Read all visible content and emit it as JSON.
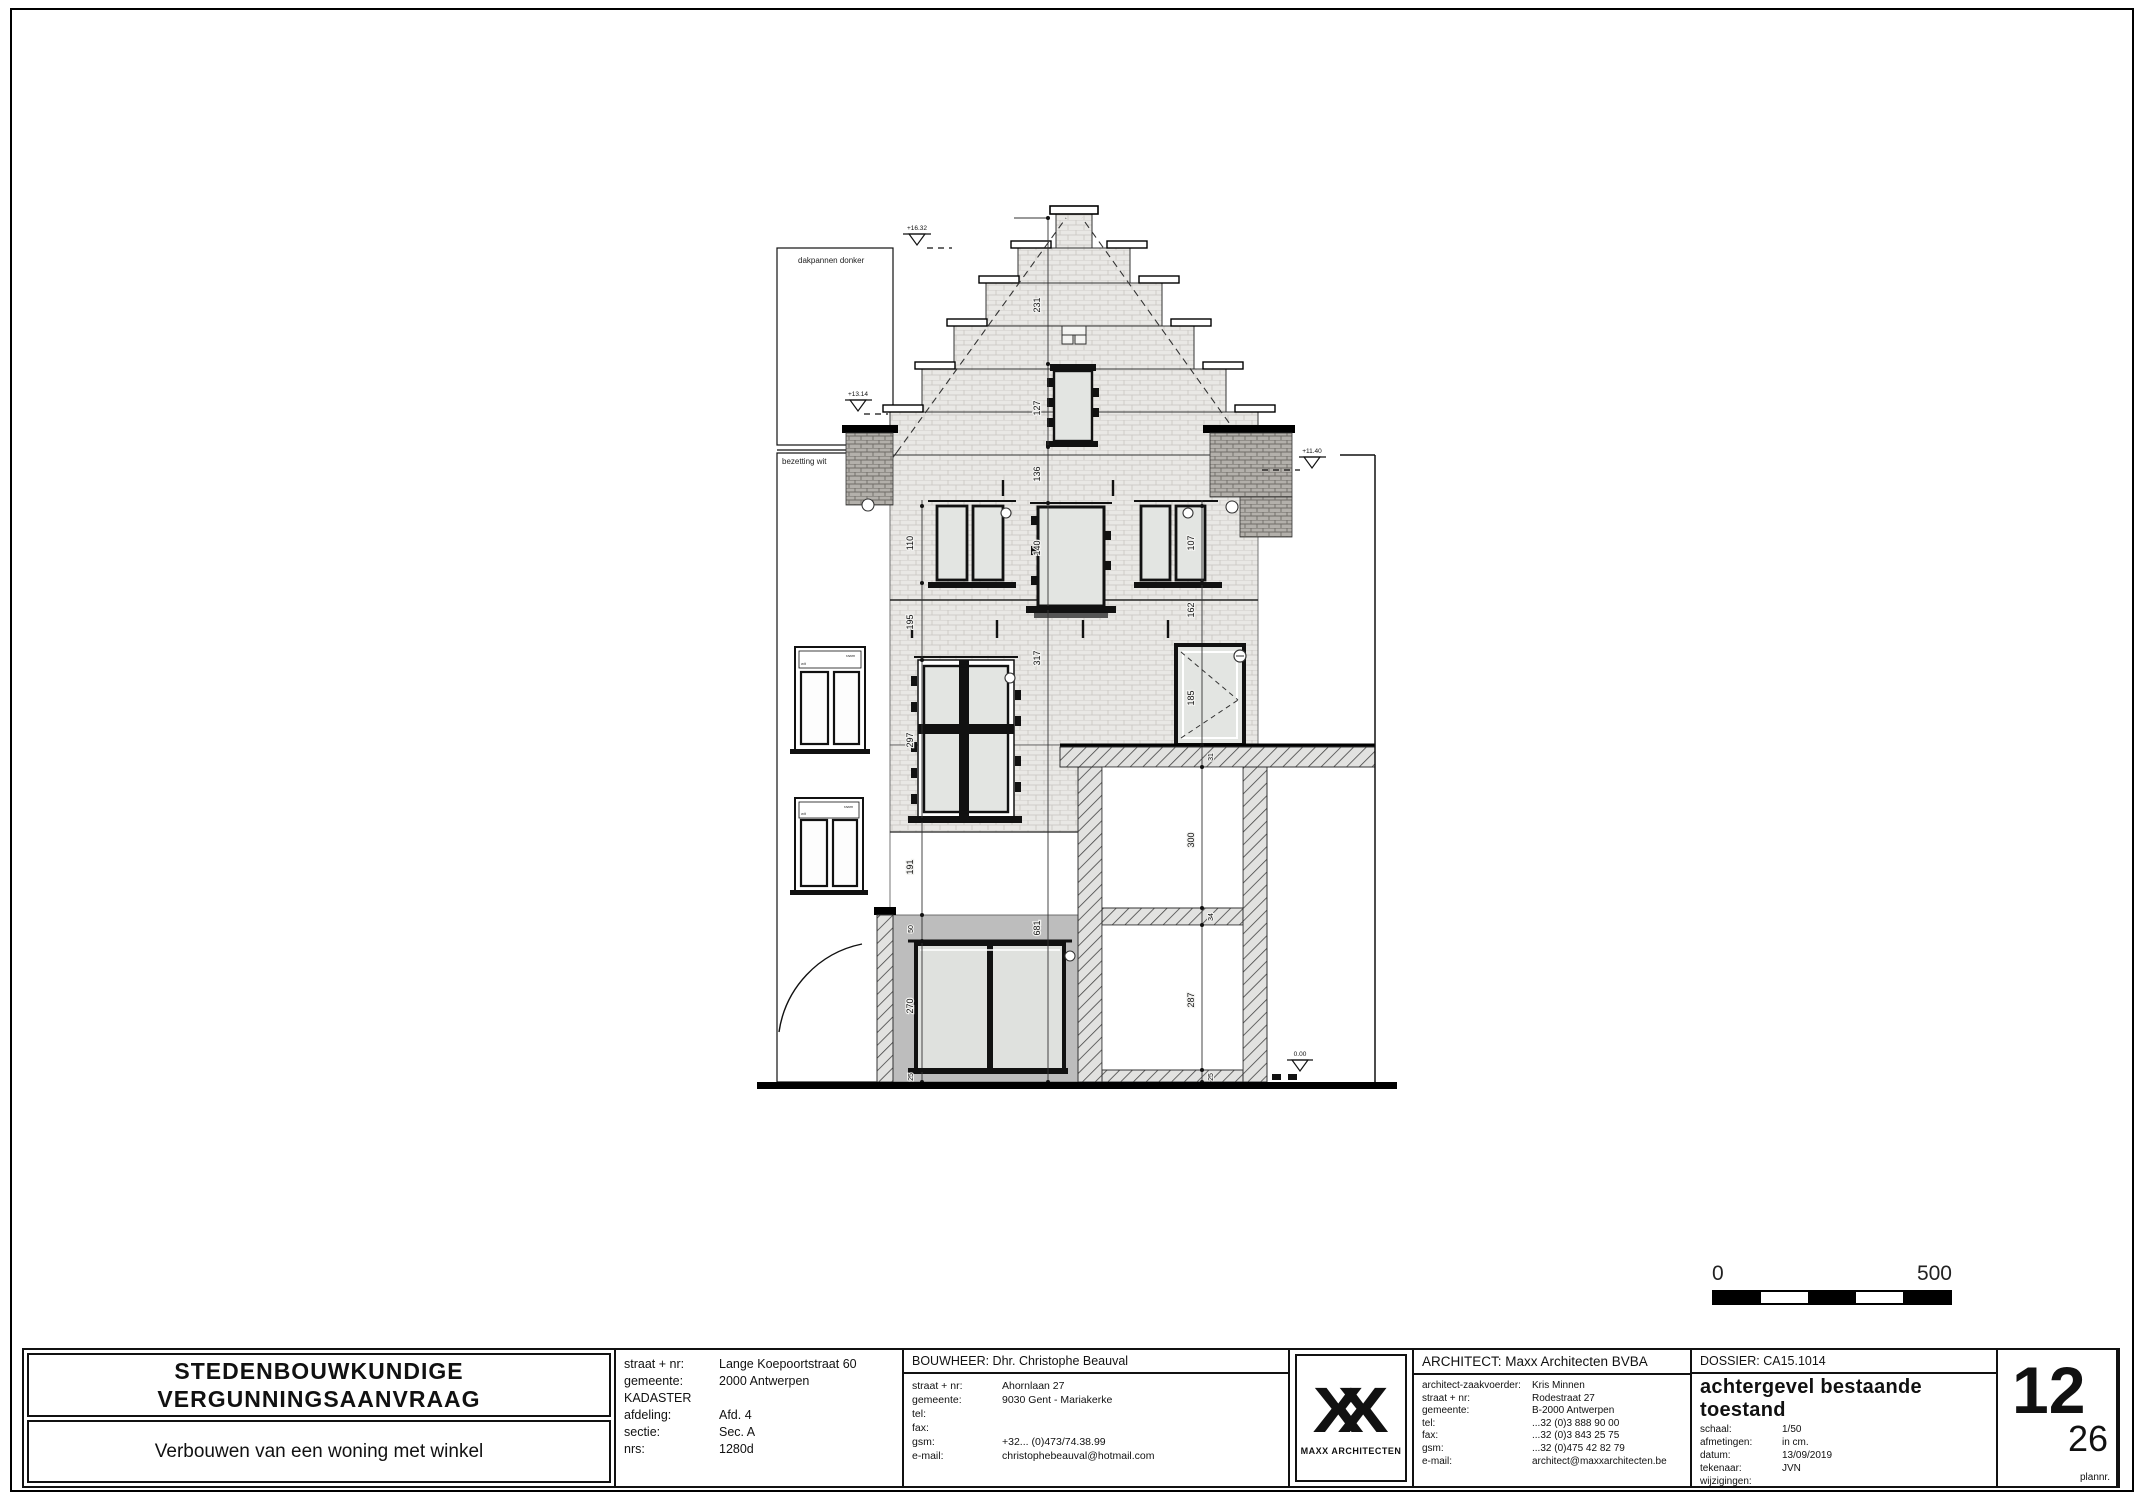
{
  "drawing": {
    "neighbor": {
      "roof_label": "dakpannen donker",
      "plaster_label": "bezetting wit",
      "window_note_line1": "raam",
      "window_note_line2": "wit"
    },
    "levels": {
      "gable_top": "+16.32",
      "neighbor_ridge": "+13.14",
      "eaves_right": "+11.40",
      "ground": "0.00"
    },
    "dims": {
      "gable_upper": "231",
      "gable_window": "127",
      "gable_base": "136",
      "window_center": "140",
      "window_left_pair": "110",
      "window_right_pair": "107",
      "left_sill_zone": "195",
      "right_sill_zone": "162",
      "first_floor": "317",
      "cross_window": "297",
      "door": "185",
      "left_lower": "191",
      "shop_lintel": "50",
      "shop_window": "270",
      "shop_sill": "25",
      "ground_floor_total": "681",
      "annex_roof": "31",
      "annex_opening_upper": "300",
      "annex_band": "34",
      "annex_opening_lower": "287",
      "annex_plinth": "25"
    }
  },
  "scalebar": {
    "start": "0",
    "end": "500"
  },
  "titleblock": {
    "project": {
      "title_line1": "STEDENBOUWKUNDIGE",
      "title_line2": "VERGUNNINGSAANVRAAG",
      "description": "Verbouwen van een woning met winkel"
    },
    "kadaster": {
      "rows": [
        {
          "label": "straat + nr:",
          "value": "Lange Koepoortstraat 60"
        },
        {
          "label": "gemeente:",
          "value": "2000 Antwerpen"
        },
        {
          "label": "KADASTER",
          "value": ""
        },
        {
          "label": "afdeling:",
          "value": "Afd. 4"
        },
        {
          "label": "sectie:",
          "value": "Sec. A"
        },
        {
          "label": "nrs:",
          "value": "1280d"
        }
      ]
    },
    "bouwheer": {
      "header": "BOUWHEER:  Dhr. Christophe Beauval",
      "rows": [
        {
          "label": "straat + nr:",
          "value": "Ahornlaan 27"
        },
        {
          "label": "gemeente:",
          "value": "9030 Gent - Mariakerke"
        },
        {
          "label": "tel:",
          "value": ""
        },
        {
          "label": "fax:",
          "value": ""
        },
        {
          "label": "gsm:",
          "value": "+32... (0)473/74.38.99"
        },
        {
          "label": "e-mail:",
          "value": "christophebeauval@hotmail.com"
        }
      ]
    },
    "logo": {
      "glyph": "XX",
      "name": "MAXX ARCHITECTEN"
    },
    "architect": {
      "header": "ARCHITECT: Maxx Architecten BVBA",
      "rows": [
        {
          "label": "architect-zaakvoerder:",
          "value": "Kris Minnen"
        },
        {
          "label": "straat + nr:",
          "value": "Rodestraat 27"
        },
        {
          "label": "gemeente:",
          "value": "B-2000 Antwerpen"
        },
        {
          "label": "tel:",
          "value": "...32 (0)3 888 90 00"
        },
        {
          "label": "fax:",
          "value": "...32 (0)3 843 25 75"
        },
        {
          "label": "gsm:",
          "value": "...32 (0)475 42 82 79"
        },
        {
          "label": "e-mail:",
          "value": "architect@maxxarchitecten.be"
        }
      ]
    },
    "dossier": {
      "header": "DOSSIER: CA15.1014",
      "sheet_title": "achtergevel bestaande toestand",
      "rows": [
        {
          "label": "schaal:",
          "value": "1/50"
        },
        {
          "label": "afmetingen:",
          "value": "in cm."
        },
        {
          "label": "datum:",
          "value": "13/09/2019"
        },
        {
          "label": "tekenaar:",
          "value": "JVN"
        },
        {
          "label": "wijzigingen:",
          "value": ""
        }
      ]
    },
    "sheet": {
      "number": "12",
      "total": "26",
      "caption": "plannr."
    }
  }
}
